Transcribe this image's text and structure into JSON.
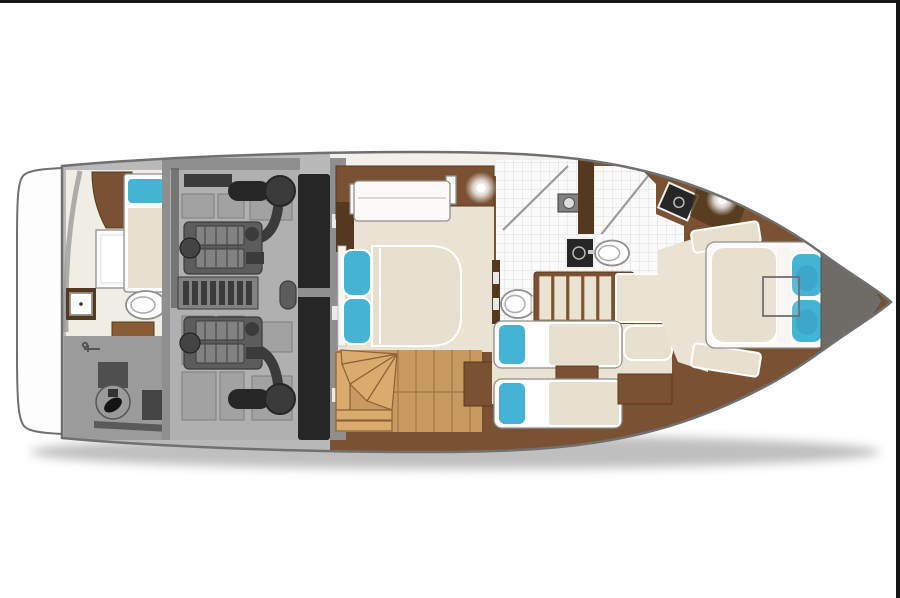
{
  "scene": {
    "type": "yacht-lower-deck-floor-plan",
    "orientation": "bow-right",
    "regions": [
      {
        "name": "swim-platform"
      },
      {
        "name": "crew-cabin-aft"
      },
      {
        "name": "lazarette-deck"
      },
      {
        "name": "engine-room"
      },
      {
        "name": "vip-cabin"
      },
      {
        "name": "day-head"
      },
      {
        "name": "companionway-stairs"
      },
      {
        "name": "twin-cabin"
      },
      {
        "name": "master-head"
      },
      {
        "name": "master-cabin"
      },
      {
        "name": "bow-locker"
      }
    ],
    "counts": {
      "engines": 2,
      "mufflers": 2,
      "beds": 5,
      "toilets": 3,
      "sinks": 4,
      "showers": 2,
      "ceiling_lights": 2
    }
  },
  "palette": {
    "background": "#ffffff",
    "border_line": "#151515",
    "hull_outline": "#707070",
    "hull_gray": "#b9b9b9",
    "swim_platform": "#fdfdfd",
    "crew_floor": "#f0ede4",
    "deck_white": "#f2f0ea",
    "deck_gray": "#9b9b9b",
    "wall_gray": "#8f8f8f",
    "engine_floor": "#b0b0b0",
    "engine_panel": "#a2a2a2",
    "engine_panel_line": "#7e7e7e",
    "machinery_dark": "#3b3b3b",
    "machinery_mid": "#5c5c5c",
    "machinery_light": "#828282",
    "bulkhead": "#262626",
    "wall_brown": "#7a5233",
    "wall_brown_dark": "#54391f",
    "cabinet_brown": "#8a5c36",
    "floor_cream": "#eae3d3",
    "mattress_cream": "#e7e0cf",
    "upholstery_white": "#fbfaf8",
    "band_white": "#f7f6f3",
    "pillow_teal": "#45b3d4",
    "pillow_teal_dark": "#2f9cc0",
    "wood_floor": "#c79a62",
    "wood_line": "#a87c48",
    "stair_tan": "#d9ab6c",
    "stair_line": "#8a6236",
    "tile_white": "#fafafa",
    "tile_line": "#dedede",
    "fixture_outline": "#8f8f8f",
    "glass_line": "#9a9a9a",
    "bow_gray": "#6f6b66",
    "shadow": "#808080"
  }
}
